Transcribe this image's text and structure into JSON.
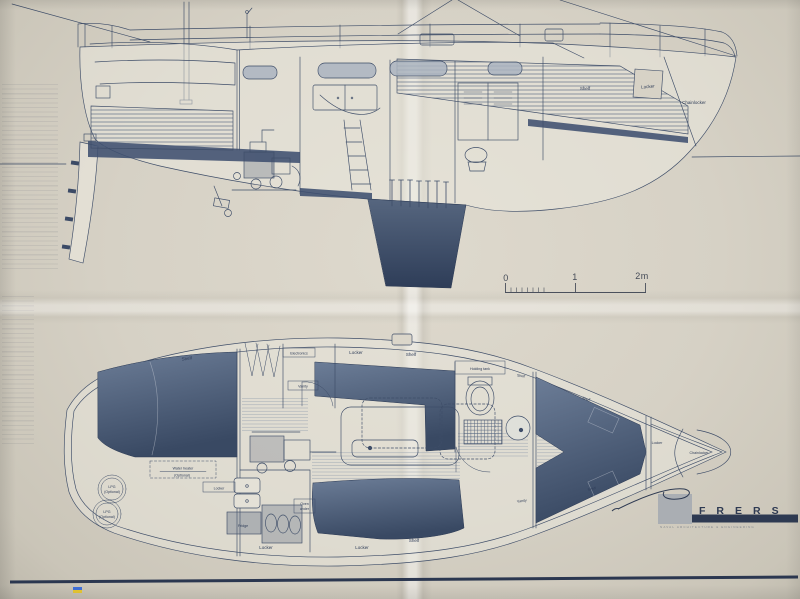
{
  "side_view": {
    "labels": {
      "shelf": "Shelf",
      "locker": "Locker",
      "chainlocker": "Chainlocker"
    }
  },
  "scale_bar": {
    "t0": "0",
    "t1": "1",
    "t2": "2m"
  },
  "plan_view": {
    "labels": {
      "shelf_aft": "Shelf",
      "electronics": "Electronics",
      "vanity_aft": "Vanity",
      "locker_saloon": "Locker",
      "shelf_saloon": "Shelf",
      "holding_tank": "Holding tank",
      "shelf_head": "Shelf",
      "shelf_fwd_port": "Shelf",
      "vanity_fwd": "Vanity",
      "shelf_fwd_stbd": "Shelf",
      "locker_bow": "Locker",
      "chainlocker": "Chainlocker",
      "water_heater_1": "Water heater",
      "water_heater_2": "(Optional)",
      "lpg_1": "LPG",
      "lpg_2": "(Optional)",
      "locker_galley": "Locker",
      "fridge": "Fridge",
      "oven_1": "Oven",
      "oven_2": "under",
      "locker_aft_btm": "Locker",
      "locker_saloon_btm": "Locker",
      "shelf_saloon_btm": "Shelf"
    }
  },
  "logo": {
    "wordmark": "FRERS",
    "tagline": "NAVAL ARCHITECTURE & ENGINEERING"
  },
  "colors": {
    "ink": "#3e4d68",
    "dark_fill": "#415270",
    "paper": "#d5d0c4",
    "logo_navy": "#2e3a52"
  }
}
